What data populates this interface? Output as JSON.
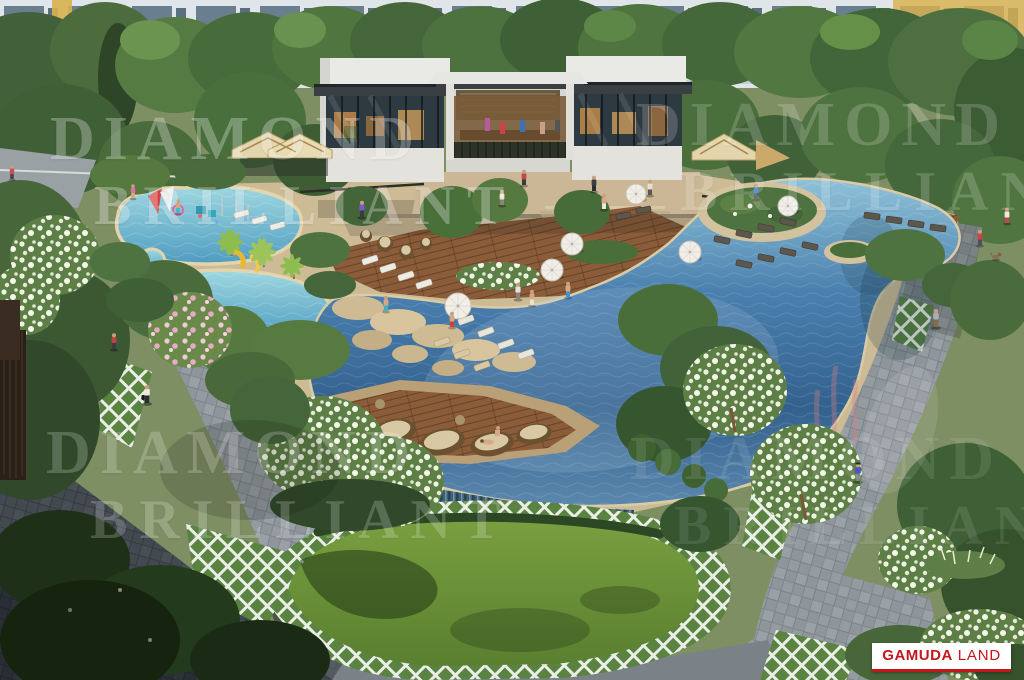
{
  "watermark": {
    "line1": "DIAMOND",
    "line2": "BRILLIANT"
  },
  "logo": {
    "brand": "GAMUDA",
    "suffix": "LAND"
  },
  "palette": {
    "logo_red": "#c5161d",
    "pool_deep_blue": "#3a6a9e",
    "pool_light_turquoise": "#9fd8e0",
    "deck_wood_brown": "#8a5c39",
    "lawn_green": "#6f9a3e",
    "tree_green": "#47663a",
    "path_gray": "#8f969b",
    "facade_gray_blue": "#dde3e6",
    "accent_yellow": "#d9b14e",
    "watermark_white": "#ffffff"
  }
}
